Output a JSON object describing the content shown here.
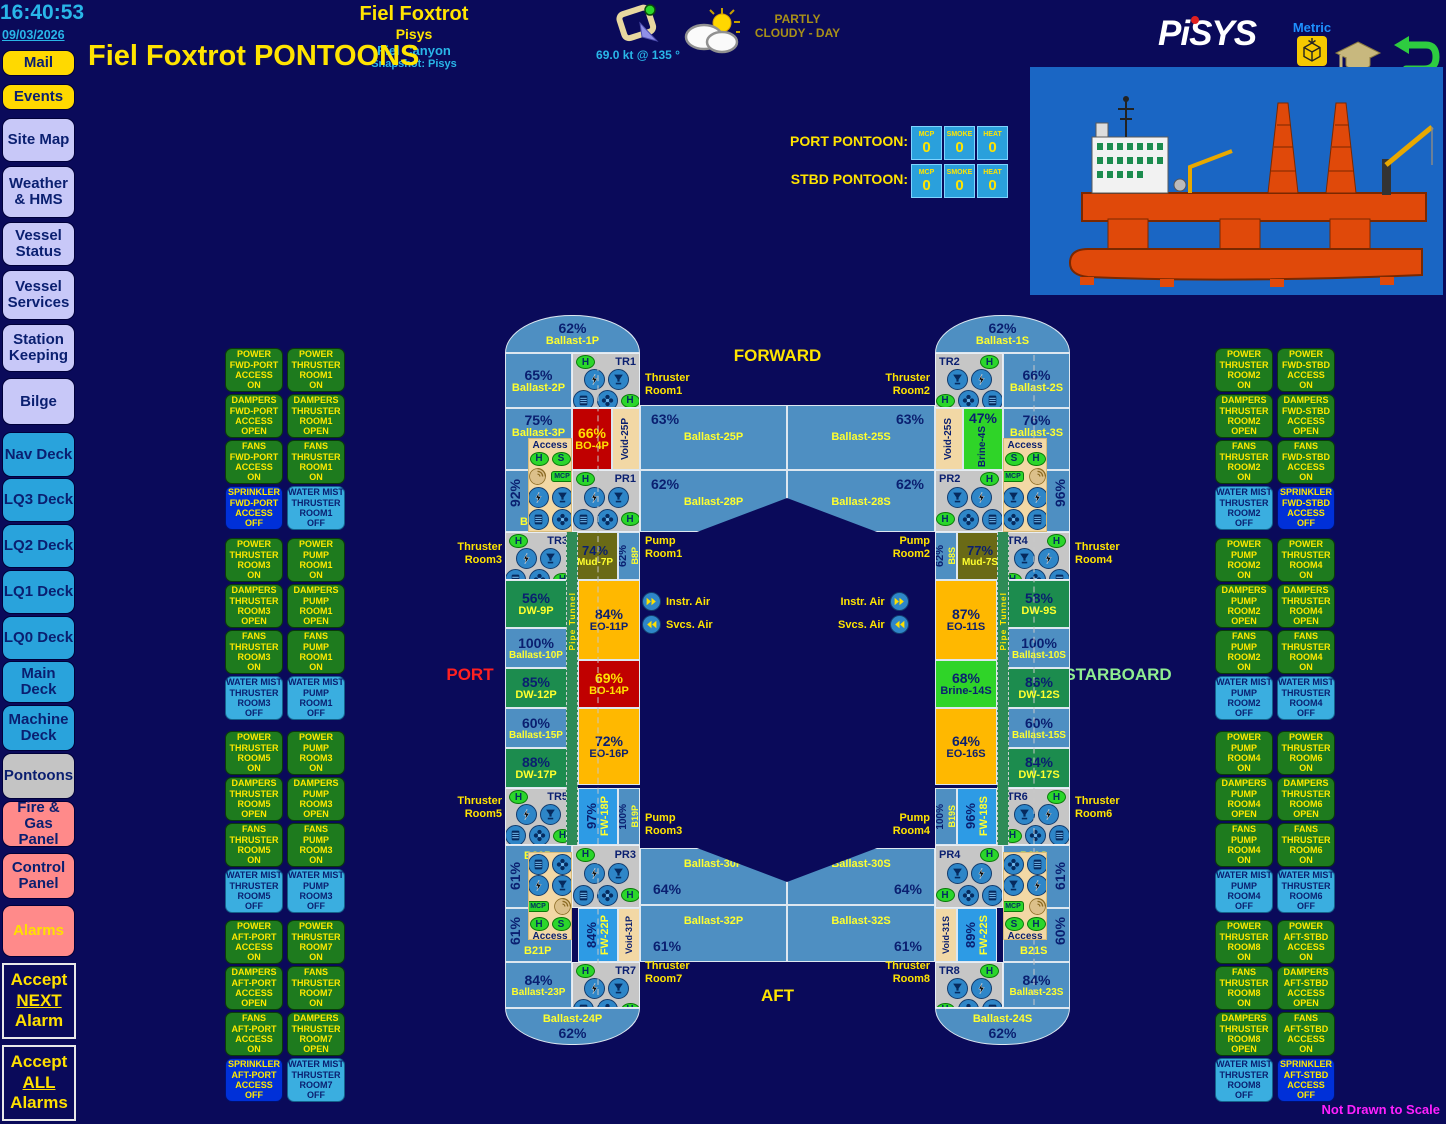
{
  "clock": {
    "time": "16:40:53",
    "date": "09/03/2026"
  },
  "header": {
    "vessel": "Fiel Foxtrot",
    "system": "Pisys",
    "field": "Fiel Canyon",
    "snapshot": "Snapshot: Pisys",
    "page_title": "Fiel Foxtrot PONTOONS",
    "wind": "69.0 kt @ 135 °",
    "weather": "PARTLY\nCLOUDY - DAY",
    "logo": "PiSYS",
    "units": "Metric",
    "not_to_scale": "Not Drawn to Scale"
  },
  "counters": {
    "port_label": "PORT PONTOON:",
    "stbd_label": "STBD PONTOON:",
    "cols": [
      "MCP",
      "SMOKE",
      "HEAT"
    ],
    "port": [
      "0",
      "0",
      "0"
    ],
    "stbd": [
      "0",
      "0",
      "0"
    ]
  },
  "compass": {
    "forward": "FORWARD",
    "aft": "AFT",
    "port": "PORT",
    "starboard": "STARBOARD"
  },
  "air": {
    "instr": "Instr. Air",
    "svcs": "Svcs. Air"
  },
  "badges": {
    "h": "H",
    "s": "S",
    "mcp": "MCP",
    "access": "Access",
    "pipe_tunnel": "Pipe Tunnel"
  },
  "icons": {
    "power": "lightning-bolt-in-circle",
    "damper": "vent-funnel-in-circle",
    "louver": "filter-louver-in-circle",
    "fan": "fan-blades-in-circle",
    "heat_detector": "green-ellipse-H",
    "smoke_detector": "green-ellipse-S",
    "manual_call_point": "green-MCP-tag",
    "sprinkler": "spiral-rose",
    "instr_air": "double-arrow-right",
    "svcs_air": "double-arrow-left"
  },
  "sidebar": {
    "items": [
      {
        "t": "Mail",
        "s": "s-y"
      },
      {
        "t": "Events",
        "s": "s-y"
      },
      {
        "t": "Site Map",
        "s": "s-l"
      },
      {
        "t": "Weather\n& HMS",
        "s": "s-l"
      },
      {
        "t": "Vessel\nStatus",
        "s": "s-l"
      },
      {
        "t": "Vessel\nServices",
        "s": "s-l"
      },
      {
        "t": "Station\nKeeping",
        "s": "s-l"
      },
      {
        "t": "Bilge",
        "s": "s-l"
      },
      {
        "t": "Nav Deck",
        "s": "s-c"
      },
      {
        "t": "LQ3 Deck",
        "s": "s-c"
      },
      {
        "t": "LQ2 Deck",
        "s": "s-c"
      },
      {
        "t": "LQ1 Deck",
        "s": "s-c"
      },
      {
        "t": "LQ0 Deck",
        "s": "s-c"
      },
      {
        "t": "Main\nDeck",
        "s": "s-c"
      },
      {
        "t": "Machine\nDeck",
        "s": "s-c"
      },
      {
        "t": "Pontoons",
        "s": "s-gr"
      },
      {
        "t": "Fire & Gas\nPanel",
        "s": "s-sa"
      },
      {
        "t": "Control\nPanel",
        "s": "s-sa"
      },
      {
        "t": "Alarms",
        "s": "s-al"
      }
    ],
    "accept_next": {
      "l1": "Accept",
      "l2": "NEXT",
      "l3": "Alarm"
    },
    "accept_all": {
      "l1": "Accept",
      "l2": "ALL",
      "l3": "Alarms"
    }
  },
  "rooms": {
    "tags": {
      "tr1": "TR1",
      "tr2": "TR2",
      "tr3": "TR3",
      "tr4": "TR4",
      "tr5": "TR5",
      "tr6": "TR6",
      "tr7": "TR7",
      "tr8": "TR8",
      "pr1": "PR1",
      "pr2": "PR2",
      "pr3": "PR3",
      "pr4": "PR4"
    },
    "labels": {
      "l1": "Thruster\nRoom1",
      "l2": "Thruster\nRoom2",
      "l3": "Thruster\nRoom3",
      "l4": "Thruster\nRoom4",
      "l5": "Thruster\nRoom5",
      "l6": "Thruster\nRoom6",
      "l7": "Thruster\nRoom7",
      "l8": "Thruster\nRoom8",
      "p1": "Pump\nRoom1",
      "p2": "Pump\nRoom2",
      "p3": "Pump\nRoom3",
      "p4": "Pump\nRoom4"
    }
  },
  "tanks": {
    "b1p": {
      "pct": "62%",
      "name": "Ballast-1P"
    },
    "b2p": {
      "pct": "65%",
      "name": "Ballast-2P"
    },
    "b3p": {
      "pct": "75%",
      "name": "Ballast-3P"
    },
    "bo4p": {
      "pct": "66%",
      "name": "BO-4P"
    },
    "v25p": {
      "name": "Void-25P"
    },
    "b5p": {
      "pct": "92%",
      "name": "B5P"
    },
    "mud7p": {
      "pct": "74%",
      "name": "Mud-7P"
    },
    "b8p": {
      "pct": "62%",
      "name": "B8P"
    },
    "dw9p": {
      "pct": "56%",
      "name": "DW-9P"
    },
    "eo11p": {
      "pct": "84%",
      "name": "EO-11P"
    },
    "b10p": {
      "pct": "100%",
      "name": "Ballast-10P"
    },
    "dw12p": {
      "pct": "85%",
      "name": "DW-12P"
    },
    "bo14p": {
      "pct": "69%",
      "name": "BO-14P"
    },
    "b15p": {
      "pct": "60%",
      "name": "Ballast-15P"
    },
    "eo16p": {
      "pct": "72%",
      "name": "EO-16P"
    },
    "dw17p": {
      "pct": "88%",
      "name": "DW-17P"
    },
    "fw18p": {
      "pct": "97%",
      "name": "FW-18P"
    },
    "b19p": {
      "pct": "100%",
      "name": "B19P"
    },
    "b20p": {
      "pct": "61%",
      "name": "B20P"
    },
    "b21p": {
      "pct": "61%",
      "name": "B21P"
    },
    "fw22p": {
      "pct": "84%",
      "name": "FW-22P"
    },
    "v31p": {
      "name": "Void-31P"
    },
    "b23p": {
      "pct": "84%",
      "name": "Ballast-23P"
    },
    "b24p": {
      "pct": "62%",
      "name": "Ballast-24P"
    },
    "b25p": {
      "pct": "63%",
      "name": "Ballast-25P"
    },
    "b28p": {
      "pct": "62%",
      "name": "Ballast-28P"
    },
    "b30p": {
      "pct": "64%",
      "name": "Ballast-30P"
    },
    "b32p": {
      "pct": "61%",
      "name": "Ballast-32P"
    },
    "b1s": {
      "pct": "62%",
      "name": "Ballast-1S"
    },
    "b2s": {
      "pct": "66%",
      "name": "Ballast-2S"
    },
    "b3s": {
      "pct": "76%",
      "name": "Ballast-3S"
    },
    "brine4s": {
      "pct": "47%",
      "name": "Brine-4S"
    },
    "v25s": {
      "name": "Void-25S"
    },
    "b5s": {
      "pct": "96%",
      "name": "B5S"
    },
    "mud7s": {
      "pct": "77%",
      "name": "Mud-7S"
    },
    "b8s": {
      "pct": "62%",
      "name": "B8S"
    },
    "dw9s": {
      "pct": "58%",
      "name": "DW-9S"
    },
    "eo11s": {
      "pct": "87%",
      "name": "EO-11S"
    },
    "b10s": {
      "pct": "100%",
      "name": "Ballast-10S"
    },
    "dw12s": {
      "pct": "86%",
      "name": "DW-12S"
    },
    "brine14s": {
      "pct": "68%",
      "name": "Brine-14S"
    },
    "b15s": {
      "pct": "60%",
      "name": "Ballast-15S"
    },
    "eo16s": {
      "pct": "64%",
      "name": "EO-16S"
    },
    "dw17s": {
      "pct": "84%",
      "name": "DW-17S"
    },
    "fw18s": {
      "pct": "96%",
      "name": "FW-18S"
    },
    "b19s": {
      "pct": "100%",
      "name": "B19S"
    },
    "b20s": {
      "pct": "61%",
      "name": "B20S"
    },
    "b21s": {
      "pct": "60%",
      "name": "B21S"
    },
    "fw22s": {
      "pct": "89%",
      "name": "FW-22S"
    },
    "v31s": {
      "name": "Void-31S"
    },
    "b23s": {
      "pct": "84%",
      "name": "Ballast-23S"
    },
    "b24s": {
      "pct": "62%",
      "name": "Ballast-24S"
    },
    "b25s": {
      "pct": "63%",
      "name": "Ballast-25S"
    },
    "b28s": {
      "pct": "62%",
      "name": "Ballast-28S"
    },
    "b30s": {
      "pct": "64%",
      "name": "Ballast-30S"
    },
    "b32s": {
      "pct": "61%",
      "name": "Ballast-32S"
    }
  },
  "panels": {
    "lg0": [
      {
        "t": "POWER\nFWD-PORT\nACCESS\nON",
        "s": "bs-g"
      },
      {
        "t": "POWER\nTHRUSTER\nROOM1\nON",
        "s": "bs-g"
      },
      {
        "t": "DAMPERS\nFWD-PORT\nACCESS\nOPEN",
        "s": "bs-g"
      },
      {
        "t": "DAMPERS\nTHRUSTER\nROOM1\nOPEN",
        "s": "bs-g"
      },
      {
        "t": "FANS\nFWD-PORT\nACCESS\nON",
        "s": "bs-g"
      },
      {
        "t": "FANS\nTHRUSTER\nROOM1\nON",
        "s": "bs-g"
      },
      {
        "t": "SPRINKLER\nFWD-PORT\nACCESS\nOFF",
        "s": "bs-b"
      },
      {
        "t": "WATER MIST\nTHRUSTER\nROOM1\nOFF",
        "s": "bs-m"
      }
    ],
    "lg1": [
      {
        "t": "POWER\nTHRUSTER\nROOM3\nON",
        "s": "bs-g"
      },
      {
        "t": "POWER\nPUMP\nROOM1\nON",
        "s": "bs-g"
      },
      {
        "t": "DAMPERS\nTHRUSTER\nROOM3\nOPEN",
        "s": "bs-g"
      },
      {
        "t": "DAMPERS\nPUMP\nROOM1\nOPEN",
        "s": "bs-g"
      },
      {
        "t": "FANS\nTHRUSTER\nROOM3\nON",
        "s": "bs-g"
      },
      {
        "t": "FANS\nPUMP\nROOM1\nON",
        "s": "bs-g"
      },
      {
        "t": "WATER MIST\nTHRUSTER\nROOM3\nOFF",
        "s": "bs-m"
      },
      {
        "t": "WATER MIST\nPUMP\nROOM1\nOFF",
        "s": "bs-m"
      }
    ],
    "lg2": [
      {
        "t": "POWER\nTHRUSTER\nROOM5\nON",
        "s": "bs-g"
      },
      {
        "t": "POWER\nPUMP\nROOM3\nON",
        "s": "bs-g"
      },
      {
        "t": "DAMPERS\nTHRUSTER\nROOM5\nOPEN",
        "s": "bs-g"
      },
      {
        "t": "DAMPERS\nPUMP\nROOM3\nOPEN",
        "s": "bs-g"
      },
      {
        "t": "FANS\nTHRUSTER\nROOM5\nON",
        "s": "bs-g"
      },
      {
        "t": "FANS\nPUMP\nROOM3\nON",
        "s": "bs-g"
      },
      {
        "t": "WATER MIST\nTHRUSTER\nROOM5\nOFF",
        "s": "bs-m"
      },
      {
        "t": "WATER MIST\nPUMP\nROOM3\nOFF",
        "s": "bs-m"
      }
    ],
    "lg3": [
      {
        "t": "POWER\nAFT-PORT\nACCESS\nON",
        "s": "bs-g"
      },
      {
        "t": "POWER\nTHRUSTER\nROOM7\nON",
        "s": "bs-g"
      },
      {
        "t": "DAMPERS\nAFT-PORT\nACCESS\nOPEN",
        "s": "bs-g"
      },
      {
        "t": "FANS\nTHRUSTER\nROOM7\nON",
        "s": "bs-g"
      },
      {
        "t": "FANS\nAFT-PORT\nACCESS\nON",
        "s": "bs-g"
      },
      {
        "t": "DAMPERS\nTHRUSTER\nROOM7\nOPEN",
        "s": "bs-g"
      },
      {
        "t": "SPRINKLER\nAFT-PORT\nACCESS\nOFF",
        "s": "bs-b"
      },
      {
        "t": "WATER MIST\nTHRUSTER\nROOM7\nOFF",
        "s": "bs-m"
      }
    ],
    "rg0": [
      {
        "t": "POWER\nTHRUSTER\nROOM2\nON",
        "s": "bs-g"
      },
      {
        "t": "POWER\nFWD-STBD\nACCESS\nON",
        "s": "bs-g"
      },
      {
        "t": "DAMPERS\nTHRUSTER\nROOM2\nOPEN",
        "s": "bs-g"
      },
      {
        "t": "DAMPERS\nFWD-STBD\nACCESS\nOPEN",
        "s": "bs-g"
      },
      {
        "t": "FANS\nTHRUSTER\nROOM2\nON",
        "s": "bs-g"
      },
      {
        "t": "FANS\nFWD-STBD\nACCESS\nON",
        "s": "bs-g"
      },
      {
        "t": "WATER MIST\nTHRUSTER\nROOM2\nOFF",
        "s": "bs-m"
      },
      {
        "t": "SPRINKLER\nFWD-STBD\nACCESS\nOFF",
        "s": "bs-b"
      }
    ],
    "rg1": [
      {
        "t": "POWER\nPUMP\nROOM2\nON",
        "s": "bs-g"
      },
      {
        "t": "POWER\nTHRUSTER\nROOM4\nON",
        "s": "bs-g"
      },
      {
        "t": "DAMPERS\nPUMP\nROOM2\nOPEN",
        "s": "bs-g"
      },
      {
        "t": "DAMPERS\nTHRUSTER\nROOM4\nOPEN",
        "s": "bs-g"
      },
      {
        "t": "FANS\nPUMP\nROOM2\nON",
        "s": "bs-g"
      },
      {
        "t": "FANS\nTHRUSTER\nROOM4\nON",
        "s": "bs-g"
      },
      {
        "t": "WATER MIST\nPUMP\nROOM2\nOFF",
        "s": "bs-m"
      },
      {
        "t": "WATER MIST\nTHRUSTER\nROOM4\nOFF",
        "s": "bs-m"
      }
    ],
    "rg2": [
      {
        "t": "POWER\nPUMP\nROOM4\nON",
        "s": "bs-g"
      },
      {
        "t": "POWER\nTHRUSTER\nROOM6\nON",
        "s": "bs-g"
      },
      {
        "t": "DAMPERS\nPUMP\nROOM4\nOPEN",
        "s": "bs-g"
      },
      {
        "t": "DAMPERS\nTHRUSTER\nROOM6\nOPEN",
        "s": "bs-g"
      },
      {
        "t": "FANS\nPUMP\nROOM4\nON",
        "s": "bs-g"
      },
      {
        "t": "FANS\nTHRUSTER\nROOM6\nON",
        "s": "bs-g"
      },
      {
        "t": "WATER MIST\nPUMP\nROOM4\nOFF",
        "s": "bs-m"
      },
      {
        "t": "WATER MIST\nTHRUSTER\nROOM6\nOFF",
        "s": "bs-m"
      }
    ],
    "rg3": [
      {
        "t": "POWER\nTHRUSTER\nROOM8\nON",
        "s": "bs-g"
      },
      {
        "t": "POWER\nAFT-STBD\nACCESS\nON",
        "s": "bs-g"
      },
      {
        "t": "FANS\nTHRUSTER\nROOM8\nON",
        "s": "bs-g"
      },
      {
        "t": "DAMPERS\nAFT-STBD\nACCESS\nOPEN",
        "s": "bs-g"
      },
      {
        "t": "DAMPERS\nTHRUSTER\nROOM8\nOPEN",
        "s": "bs-g"
      },
      {
        "t": "FANS\nAFT-STBD\nACCESS\nON",
        "s": "bs-g"
      },
      {
        "t": "WATER MIST\nTHRUSTER\nROOM8\nOFF",
        "s": "bs-m"
      },
      {
        "t": "SPRINKLER\nAFT-STBD\nACCESS\nOFF",
        "s": "bs-b"
      }
    ]
  },
  "colors": {
    "background": "#0A0A5A",
    "cyan": "#29B6E8",
    "yellow": "#FFE400",
    "ballast_blue": "#4E8FC2",
    "drill_water_green": "#1C8C4E",
    "oil_orange": "#FFB800",
    "base_oil_red": "#C00000",
    "mud_olive": "#6A6A16",
    "void_tan": "#F2D8A5",
    "fresh_water_blue": "#2D9BE5",
    "brine_green": "#2FD428",
    "room_gray": "#C6C6C6",
    "status_on_green": "#1E7B1E",
    "sprinkler_off_blue": "#0030D8",
    "water_mist_blue": "#3AAEE0",
    "alarm_salmon": "#FF8A8A",
    "magenta": "#FF20FF",
    "port_red": "#FF2020",
    "starboard_green": "#90EE90"
  }
}
